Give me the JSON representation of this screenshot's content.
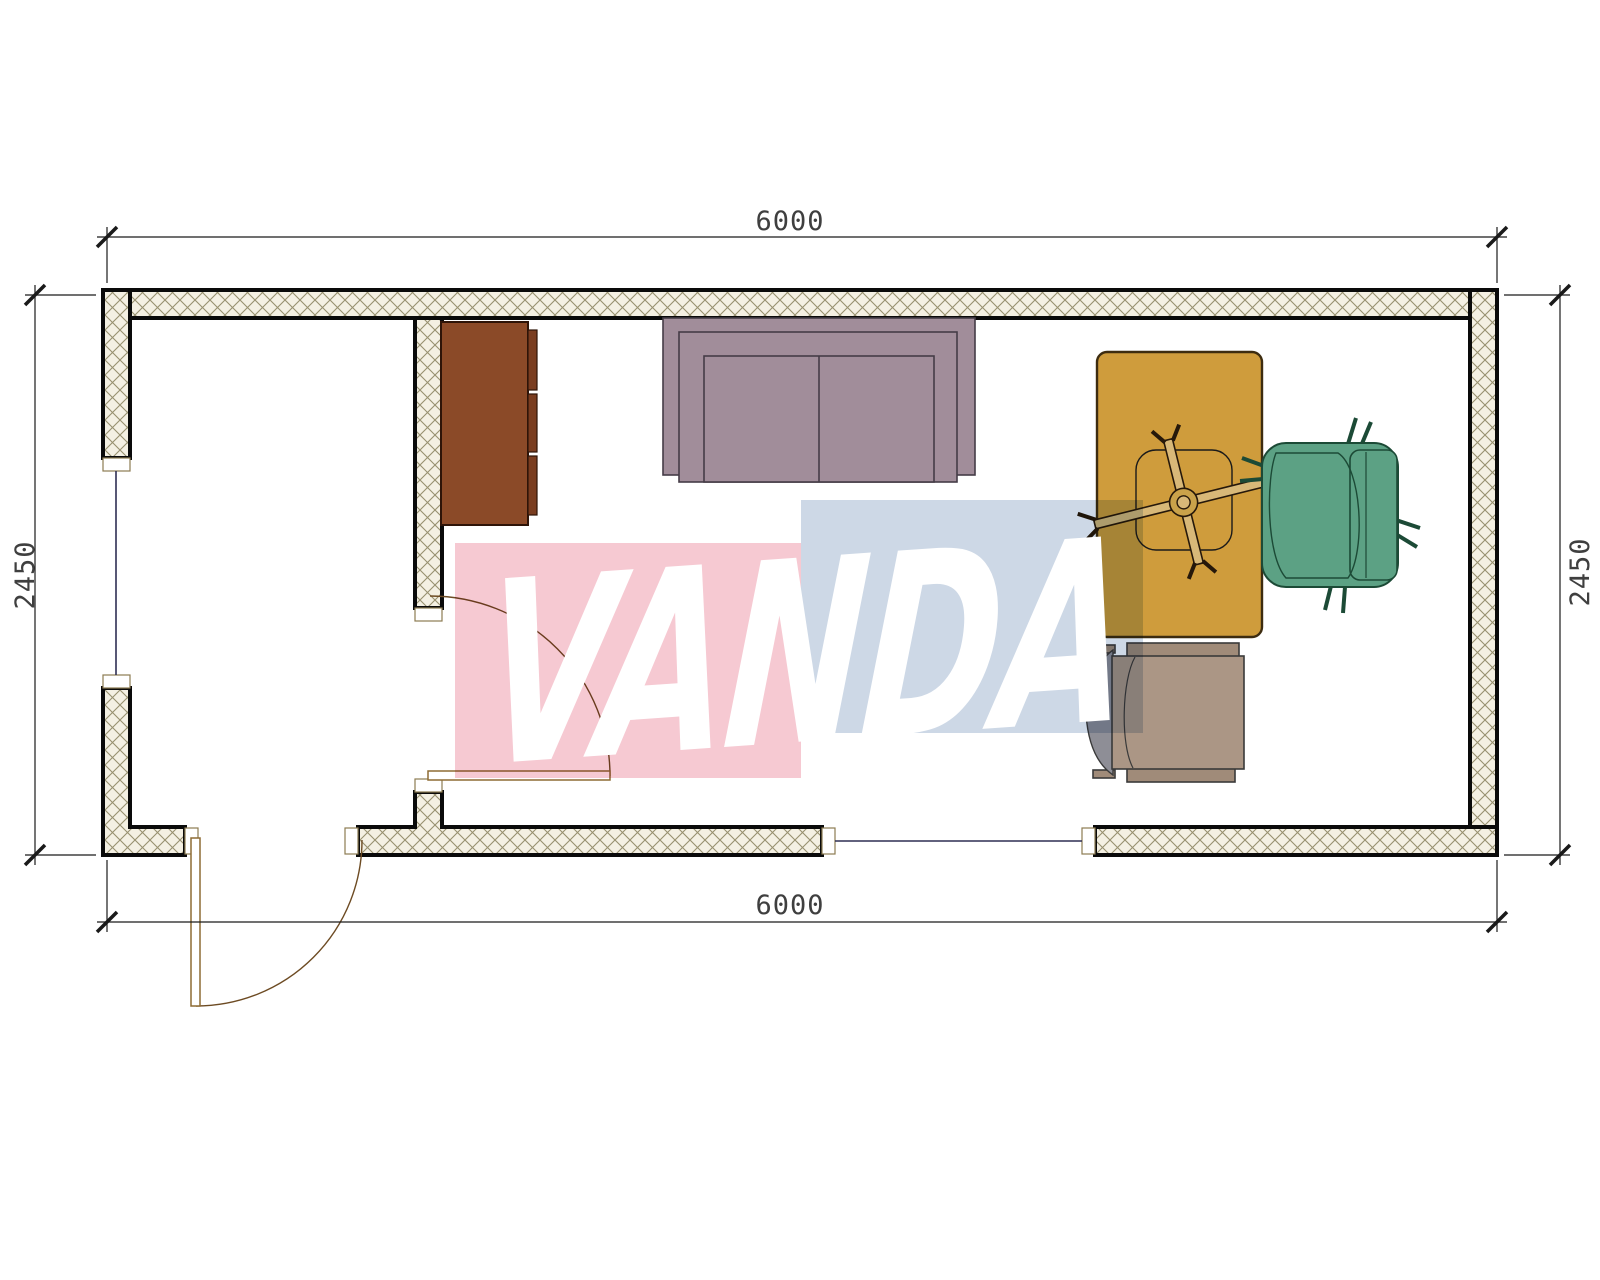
{
  "drawing": {
    "type": "floor-plan",
    "description": "Single-room container cabin plan with entry hall, interior door, exterior door, two windows and office furniture"
  },
  "dimensions": {
    "top": "6000",
    "bottom": "6000",
    "left": "2450",
    "right": "2450"
  },
  "watermark": {
    "text": "VANDA",
    "pink_block_color": "#f6c9d2",
    "blue_block_color": "#cdd8e6",
    "text_color": "#ffffff"
  },
  "colors": {
    "wall_hatch_bg": "#f4f0e3",
    "wall_hatch_line": "#97906f",
    "wall_outline": "#0a0a0a",
    "window_glass_line": "#2e2e54",
    "door_leaf_outline": "#8d6b33",
    "cabinet": "#8b4a28",
    "cabinet_drawer_strip": "#7a3d20",
    "sofa": "#a18d9a",
    "desk": "#cf9c3c",
    "desk_chair_base": "#d8b878",
    "armchair_green": "#5ca184",
    "side_chair_seat": "#ab9685",
    "side_chair_back": "#8e8e96",
    "dimension_line": "#1a1a1a"
  },
  "furniture": [
    {
      "name": "cabinet",
      "label": "sideboard cabinet"
    },
    {
      "name": "sofa",
      "label": "two-seat sofa"
    },
    {
      "name": "desk",
      "label": "office desk"
    },
    {
      "name": "desk-chair",
      "label": "swivel task chair under desk"
    },
    {
      "name": "armchair",
      "label": "green office armchair"
    },
    {
      "name": "side-chair",
      "label": "visitor chair"
    }
  ]
}
